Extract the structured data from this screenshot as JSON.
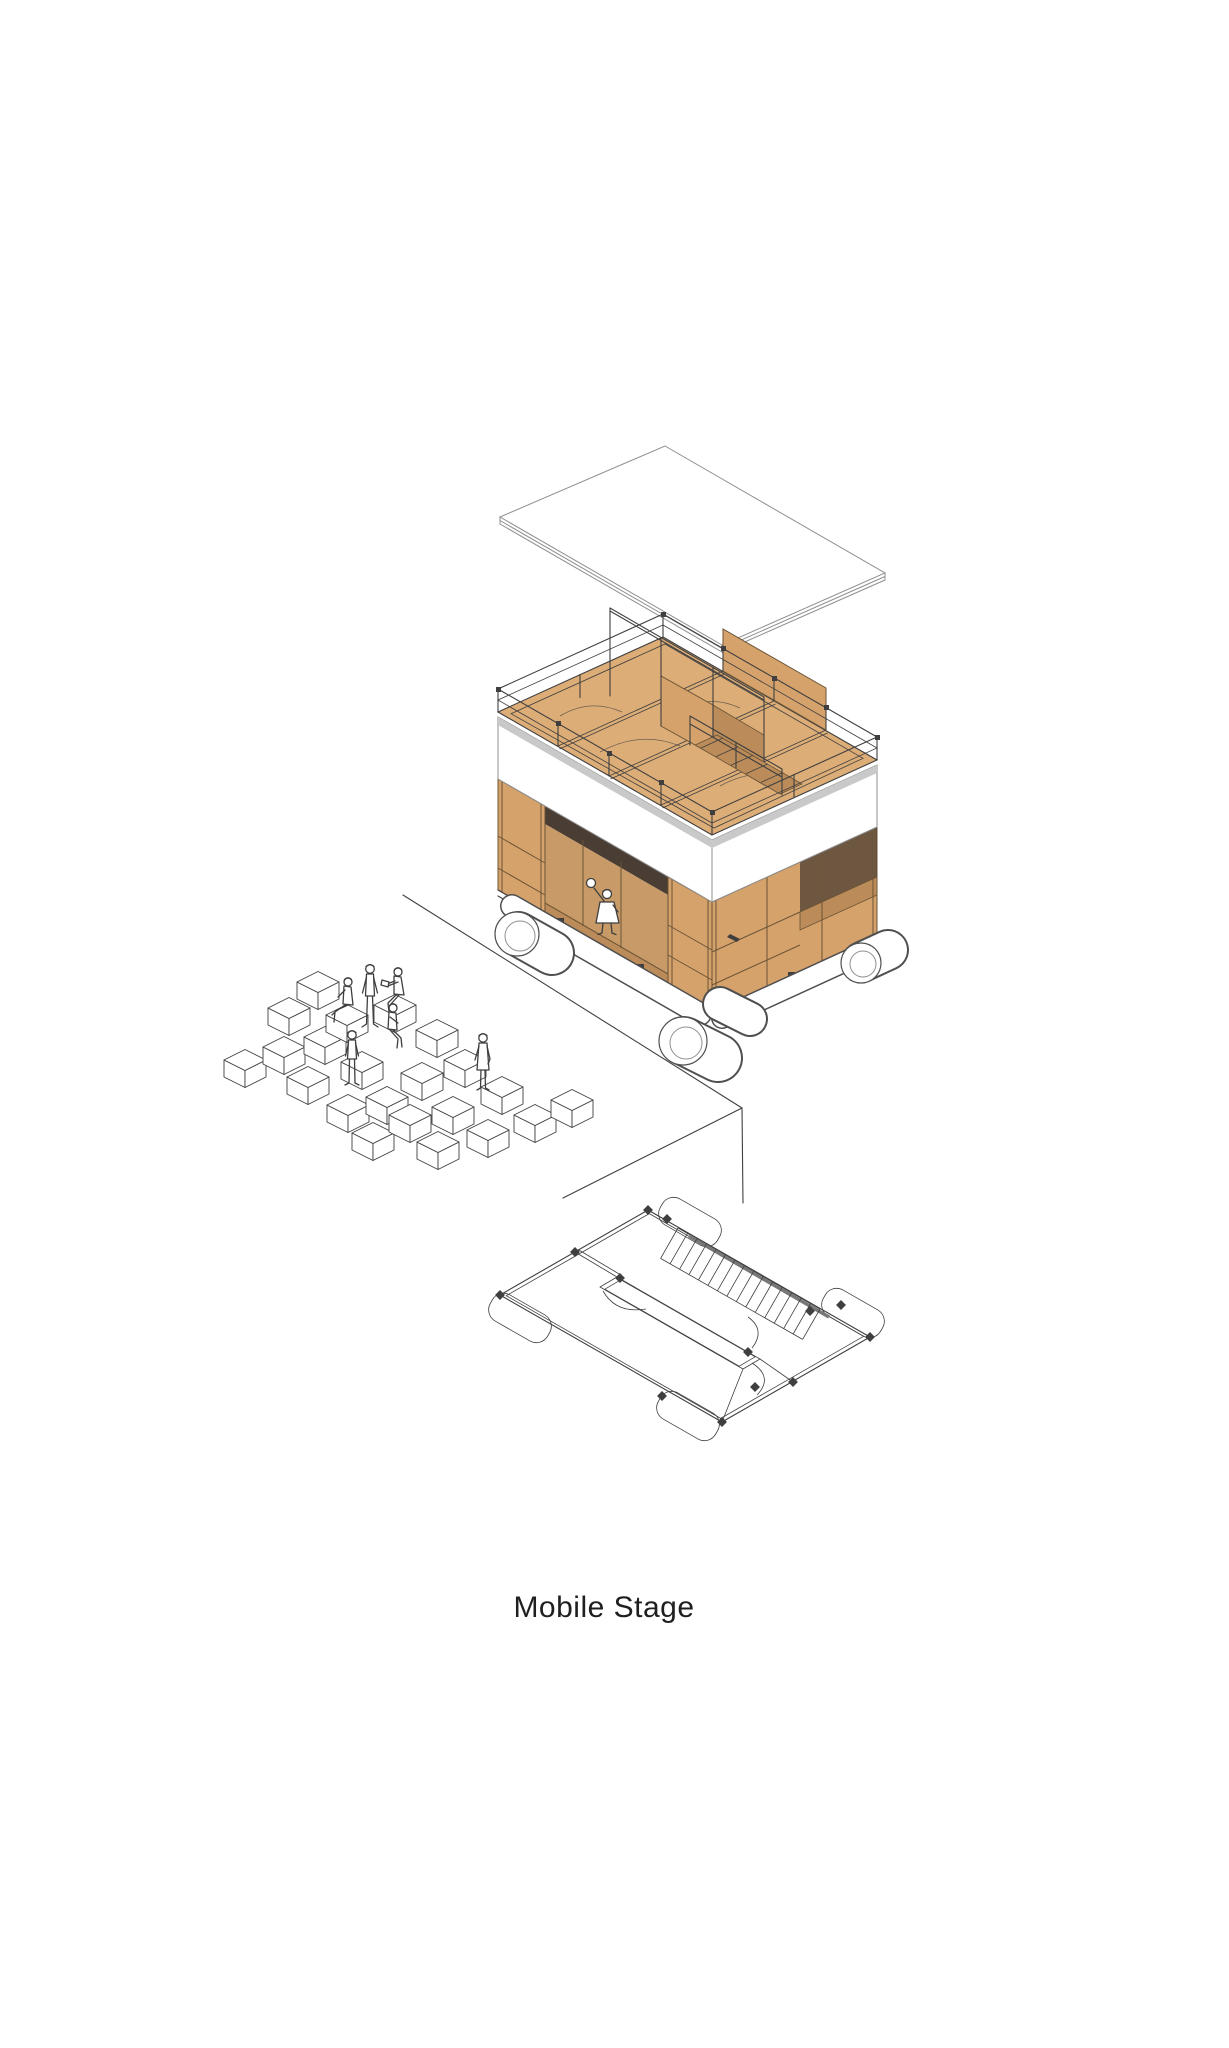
{
  "caption": {
    "title": "Mobile Stage"
  },
  "palette": {
    "background": "#ffffff",
    "line": "#3f3f3f",
    "line_light": "#8f8f8f",
    "wood_top": "#ddad77",
    "wood_light": "#e7bd8d",
    "wood_side": "#d5a26c",
    "wood_dark": "#bb8c59",
    "wood_interior": "#c79a68",
    "wood_frame": "#6b5436",
    "shadow_dark": "#4a3d33",
    "panel_white": "#ffffff",
    "fascia_gray": "#c9c9c9",
    "text": "#1f1f1f"
  },
  "scene": {
    "type": "exploded axonometric architectural drawing",
    "parts": [
      "floating roof panel",
      "two-storey timber stage module on wheels",
      "white fascia band",
      "performer child figure on lower stage",
      "audience seating cubes",
      "audience figures",
      "ground edge line",
      "isometric floor plan with stair hatch and wheel outlines"
    ],
    "audience": {
      "figure_count": 6,
      "cube_count": 22,
      "cubes": [
        [
          318,
          982
        ],
        [
          289,
          1008
        ],
        [
          245,
          1060
        ],
        [
          284,
          1047
        ],
        [
          325,
          1037
        ],
        [
          308,
          1077
        ],
        [
          348,
          1105
        ],
        [
          347,
          1015
        ],
        [
          362,
          1062
        ],
        [
          387,
          1097
        ],
        [
          373,
          1133
        ],
        [
          410,
          1115
        ],
        [
          422,
          1073
        ],
        [
          437,
          1030
        ],
        [
          395,
          1005
        ],
        [
          453,
          1107
        ],
        [
          438,
          1142
        ],
        [
          488,
          1130
        ],
        [
          465,
          1060
        ],
        [
          502,
          1087
        ],
        [
          535,
          1115
        ],
        [
          572,
          1100
        ]
      ]
    },
    "plan": {
      "stair_hatch": {
        "x1": 678,
        "y1": 1228,
        "x2": 820,
        "y2": 1309,
        "dx": -17.4,
        "dy": 30.4,
        "count": 16
      }
    }
  }
}
